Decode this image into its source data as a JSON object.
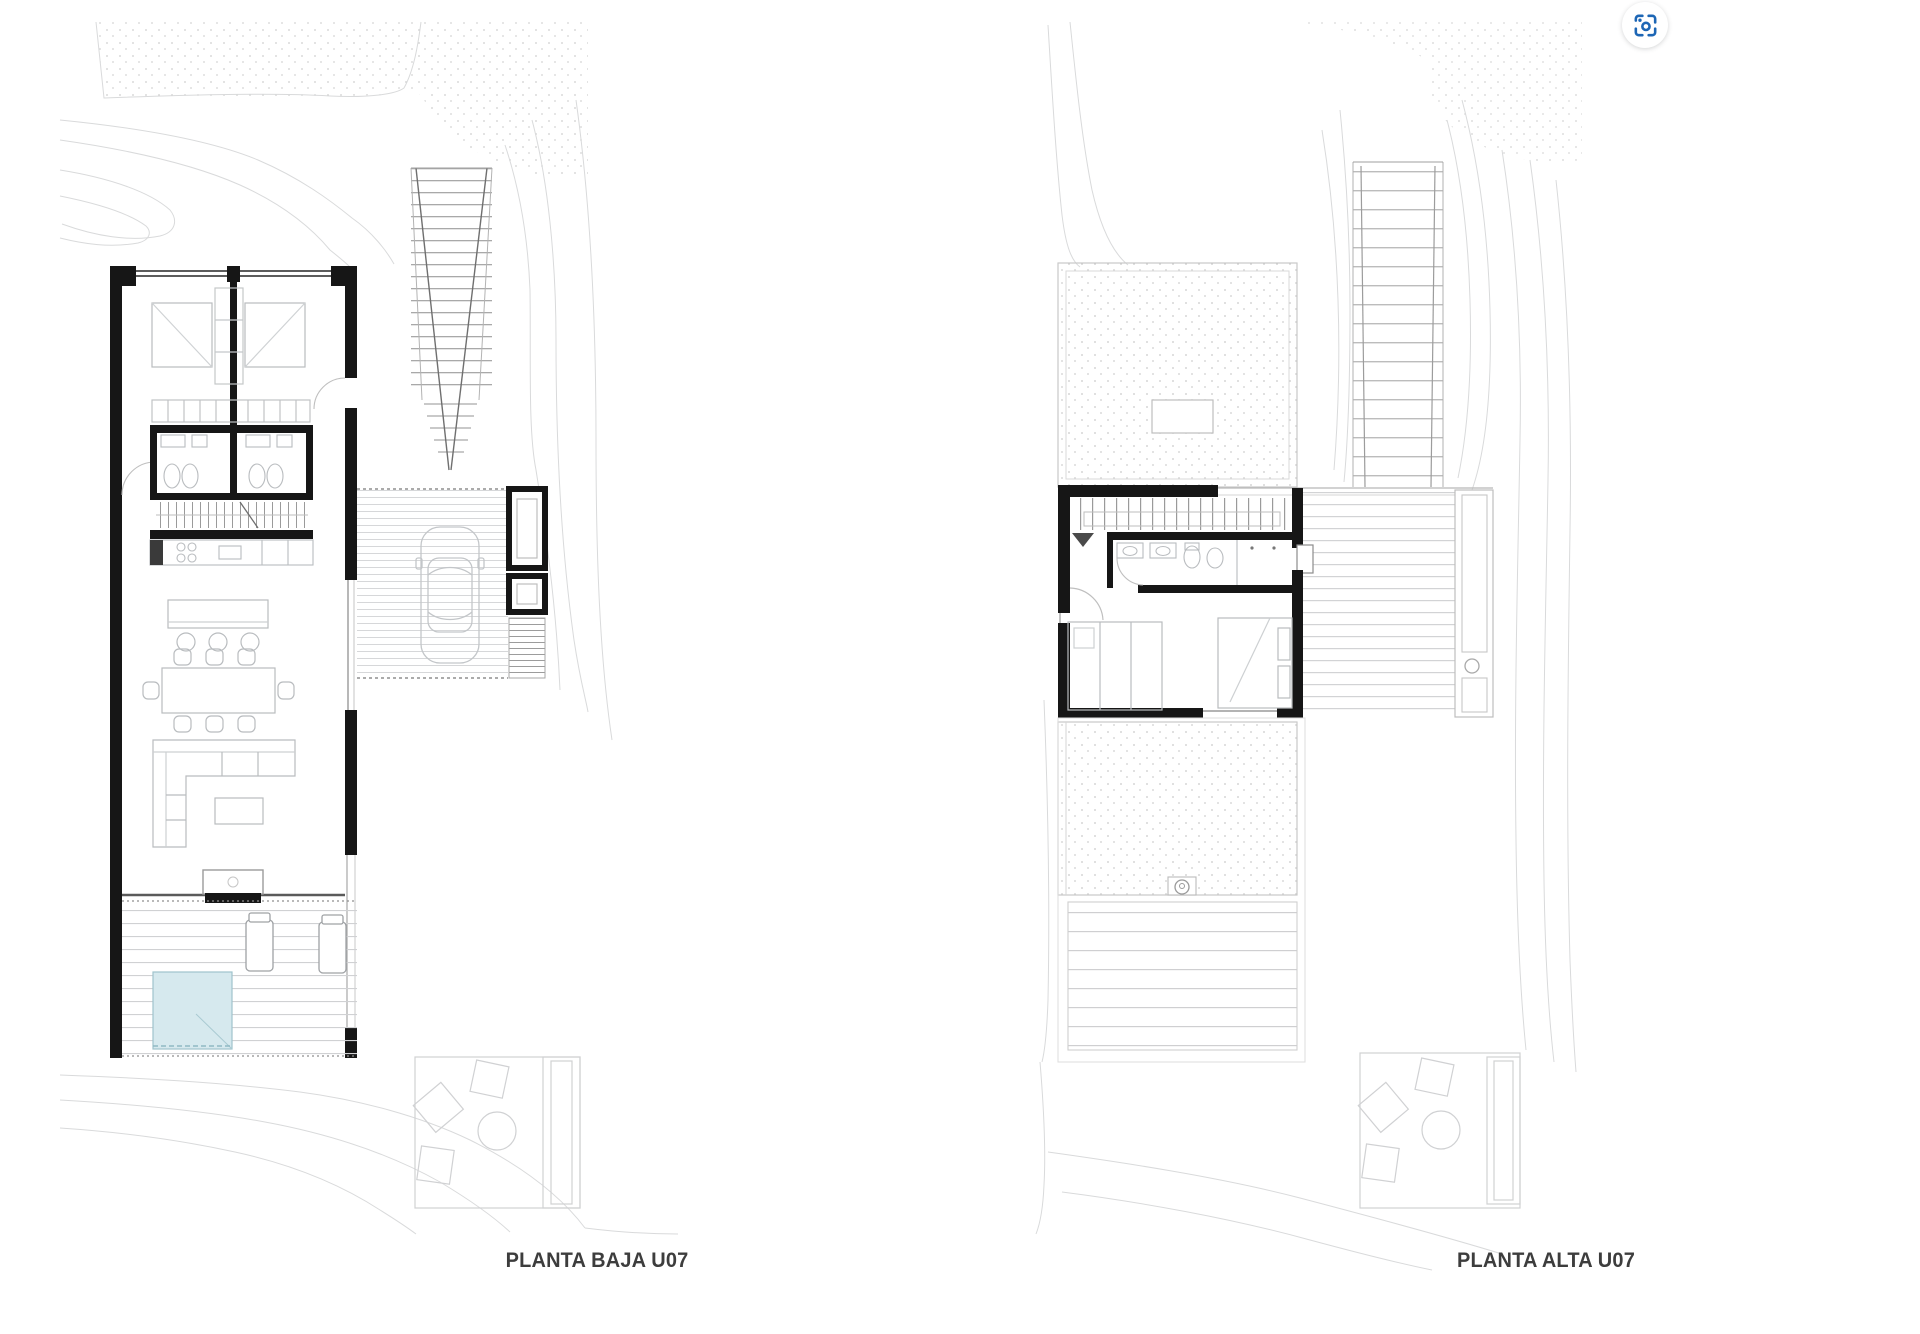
{
  "plans": [
    {
      "id": "planta-baja",
      "label": "PLANTA BAJA U07"
    },
    {
      "id": "planta-alta",
      "label": "PLANTA ALTA U07"
    }
  ],
  "lens_button": {
    "aria_label": "Search with image",
    "icon": "google-lens-icon"
  },
  "colors": {
    "wall": "#161616",
    "furniture_line": "#b9bcbf",
    "contour_line": "#d9dadb",
    "deck_line": "#d3d4d6",
    "stipple_dot": "#c9c9c9",
    "pool_fill": "#d6e9ee",
    "pool_edge": "#9fc3cc",
    "lens_blue": "#1d66b5",
    "label_text": "#3d3d3d"
  }
}
